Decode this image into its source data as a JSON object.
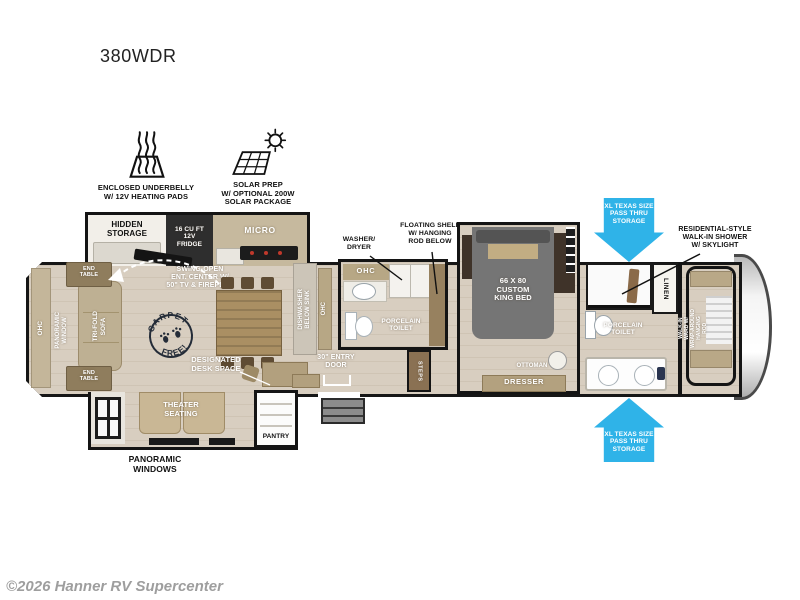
{
  "title": "380WDR",
  "copyright": "©2026 Hanner RV Supercenter",
  "colors": {
    "arrow_blue": "#2fb3e8",
    "wall": "#141414",
    "floor": "#d8cec0"
  },
  "feature_icons": {
    "underbelly": {
      "icon": "heating-pads-icon",
      "label": "ENCLOSED UNDERBELLY\nW/ 12V HEATING PADS"
    },
    "solar": {
      "icon": "solar-panel-icon",
      "label": "SOLAR PREP\nW/ OPTIONAL 200W\nSOLAR PACKAGE"
    }
  },
  "callouts": {
    "pass_thru_top": "XL TEXAS SIZE\nPASS THRU\nSTORAGE",
    "pass_thru_bottom": "XL TEXAS SIZE\nPASS THRU\nSTORAGE",
    "shower": "RESIDENTIAL-STYLE\nWALK-IN SHOWER\nW/ SKYLIGHT",
    "floating_shelf": "FLOATING SHELF\nW/ HANGING\nROD BELOW",
    "washer_dryer": "WASHER/\nDRYER",
    "swing_open": "SWING-OPEN\nENT. CENTER W/\n50\" TV & FIREPLCE",
    "carpet_free_top": "CARPET",
    "carpet_free_bottom": "FREE!"
  },
  "rooms": {
    "hidden_storage": "HIDDEN\nSTORAGE",
    "fridge": "16 CU FT\n12V\nFRIDGE",
    "micro": "MICRO",
    "ohc_rear": "OHC",
    "panoramic_window": "PANORAMIC\nWINDOW",
    "tri_fold_sofa": "TRI-FOLD\nSOFA",
    "end_table_top": "END\nTABLE",
    "end_table_bottom": "END\nTABLE",
    "dishwasher": "DISHWASHER\nBELOW SINK",
    "ohc_kitchen": "OHC",
    "ohc_bath": "OHC",
    "porcelain_toilet_mid": "PORCELAIN\nTOILET",
    "entry_door": "30\" ENTRY\nDOOR",
    "steps": "STEPS",
    "designated_desk": "DESIGNATED\nDESK SPACE",
    "theater_seating": "THEATER\nSEATING",
    "panoramic_windows": "PANORAMIC\nWINDOWS",
    "pantry": "PANTRY",
    "king_bed": "66 X 80\nCUSTOM\nKING BED",
    "ottoman": "OTTOMAN",
    "dresser": "DRESSER",
    "linen": "LINEN",
    "porcelain_toilet_master": "PORCELAIN\nTOILET",
    "walk_in_ward": "WALK-IN\nWARD W/\nWRAP-AROUND\nHANGING\nROD"
  }
}
